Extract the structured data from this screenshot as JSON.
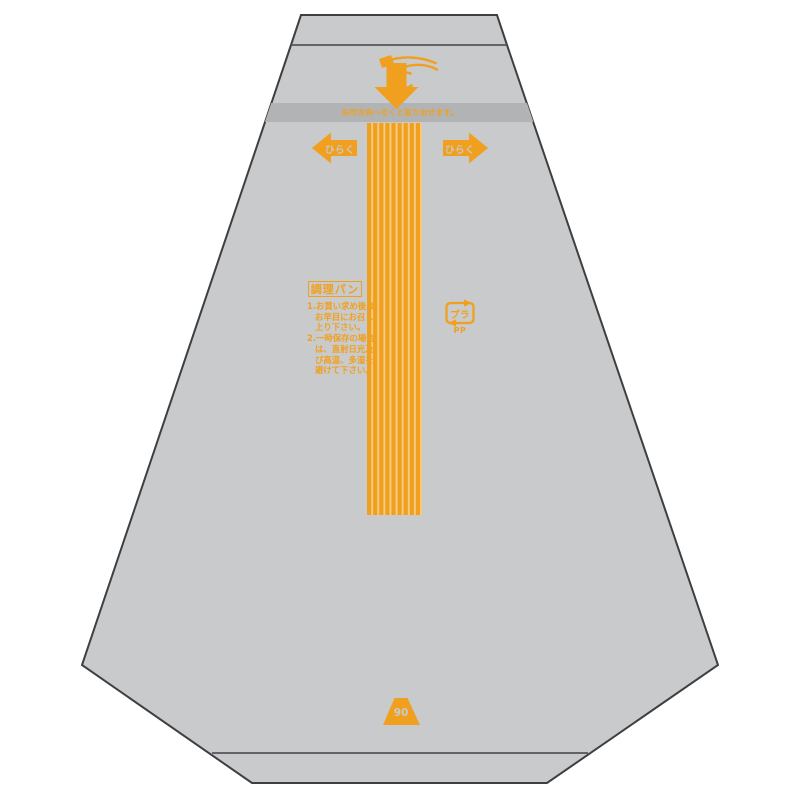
{
  "colors": {
    "orange": "#F0A01E",
    "bag_gray": "#C9CACC",
    "band_gray": "#B2B3B5",
    "stripe_light": "#F6CB82",
    "outline": "#3E3F41",
    "fold_line": "#55565A",
    "background": "#FFFFFF"
  },
  "bag": {
    "tear_strip": {
      "instruction": "矢印方向へ引くと取り出せます。"
    },
    "open_arrows": {
      "left_label": "ひらく",
      "right_label": "ひらく"
    },
    "product_type": {
      "label": "調理パン"
    },
    "instructions": [
      "1.お買い求め後は、",
      "お早目にお召し",
      "上り下さい。",
      "2.一時保存の場合",
      "は、直射日光及",
      "び高温、多湿を",
      "避けて下さい。"
    ],
    "recycle_mark": {
      "symbol": "プラ",
      "material": "PP"
    },
    "size_marker": {
      "number": "90"
    }
  },
  "icons": {
    "pull-tab-hand-icon": "hand pulling tab with down arrow",
    "down-arrow-icon": "thick down arrow",
    "open-left-arrow-icon": "left arrow",
    "open-right-arrow-icon": "right arrow",
    "plastic-recycle-mark-icon": "Japanese プラ recycling mark",
    "size-triangle-icon": "orange trapezoid size marker"
  }
}
